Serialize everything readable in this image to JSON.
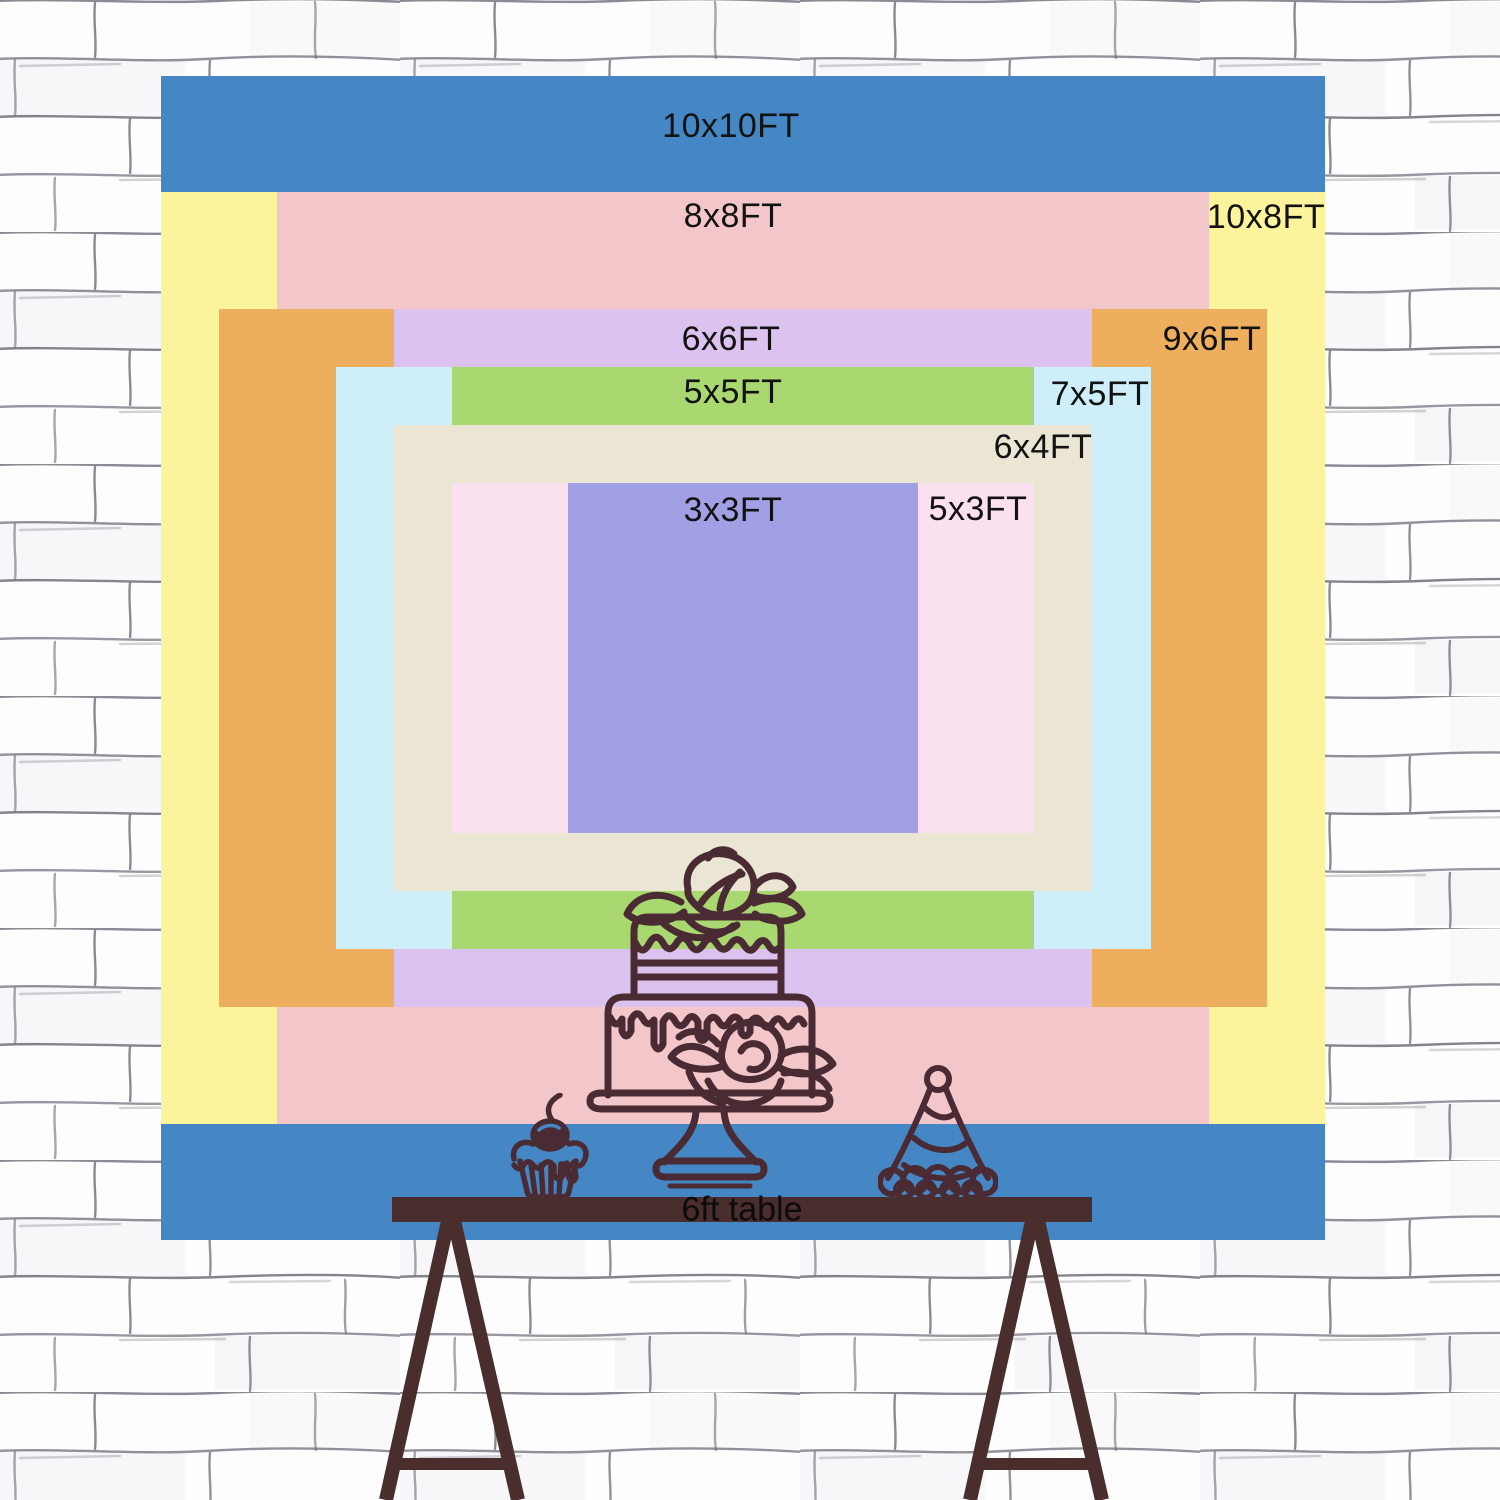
{
  "diagram": {
    "description": "Backdrop size comparison chart on brick wall with party table",
    "unit_suffix": "FT",
    "sizes": [
      {
        "id": "10x10",
        "label": "10x10FT",
        "width_ft": 10,
        "height_ft": 10,
        "color": "#4587C4"
      },
      {
        "id": "10x8",
        "label": "10x8FT",
        "width_ft": 10,
        "height_ft": 8,
        "color": "#FBF49D"
      },
      {
        "id": "8x8",
        "label": "8x8FT",
        "width_ft": 8,
        "height_ft": 8,
        "color": "#F3C7CA"
      },
      {
        "id": "9x6",
        "label": "9x6FT",
        "width_ft": 9,
        "height_ft": 6,
        "color": "#EDAE5E"
      },
      {
        "id": "6x6",
        "label": "6x6FT",
        "width_ft": 6,
        "height_ft": 6,
        "color": "#DBC2EF"
      },
      {
        "id": "7x5",
        "label": "7x5FT",
        "width_ft": 7,
        "height_ft": 5,
        "color": "#CEEFF9"
      },
      {
        "id": "5x5",
        "label": "5x5FT",
        "width_ft": 5,
        "height_ft": 5,
        "color": "#A9D870"
      },
      {
        "id": "6x4",
        "label": "6x4FT",
        "width_ft": 6,
        "height_ft": 4,
        "color": "#EBE5D3"
      },
      {
        "id": "5x3",
        "label": "5x3FT",
        "width_ft": 5,
        "height_ft": 3,
        "color": "#FBE1EF"
      },
      {
        "id": "3x3",
        "label": "3x3FT",
        "width_ft": 3,
        "height_ft": 3,
        "color": "#A2A0E5"
      }
    ],
    "table": {
      "label": "6ft table",
      "color": "#4A2E2E"
    },
    "illustrations": [
      "cupcake-icon",
      "cake-icon",
      "party-hat-icon"
    ],
    "ink_color": "#4A2B33",
    "text_color": "#121212",
    "wall": {
      "style": "white painted brick",
      "line_color": "#6D6D78"
    }
  }
}
